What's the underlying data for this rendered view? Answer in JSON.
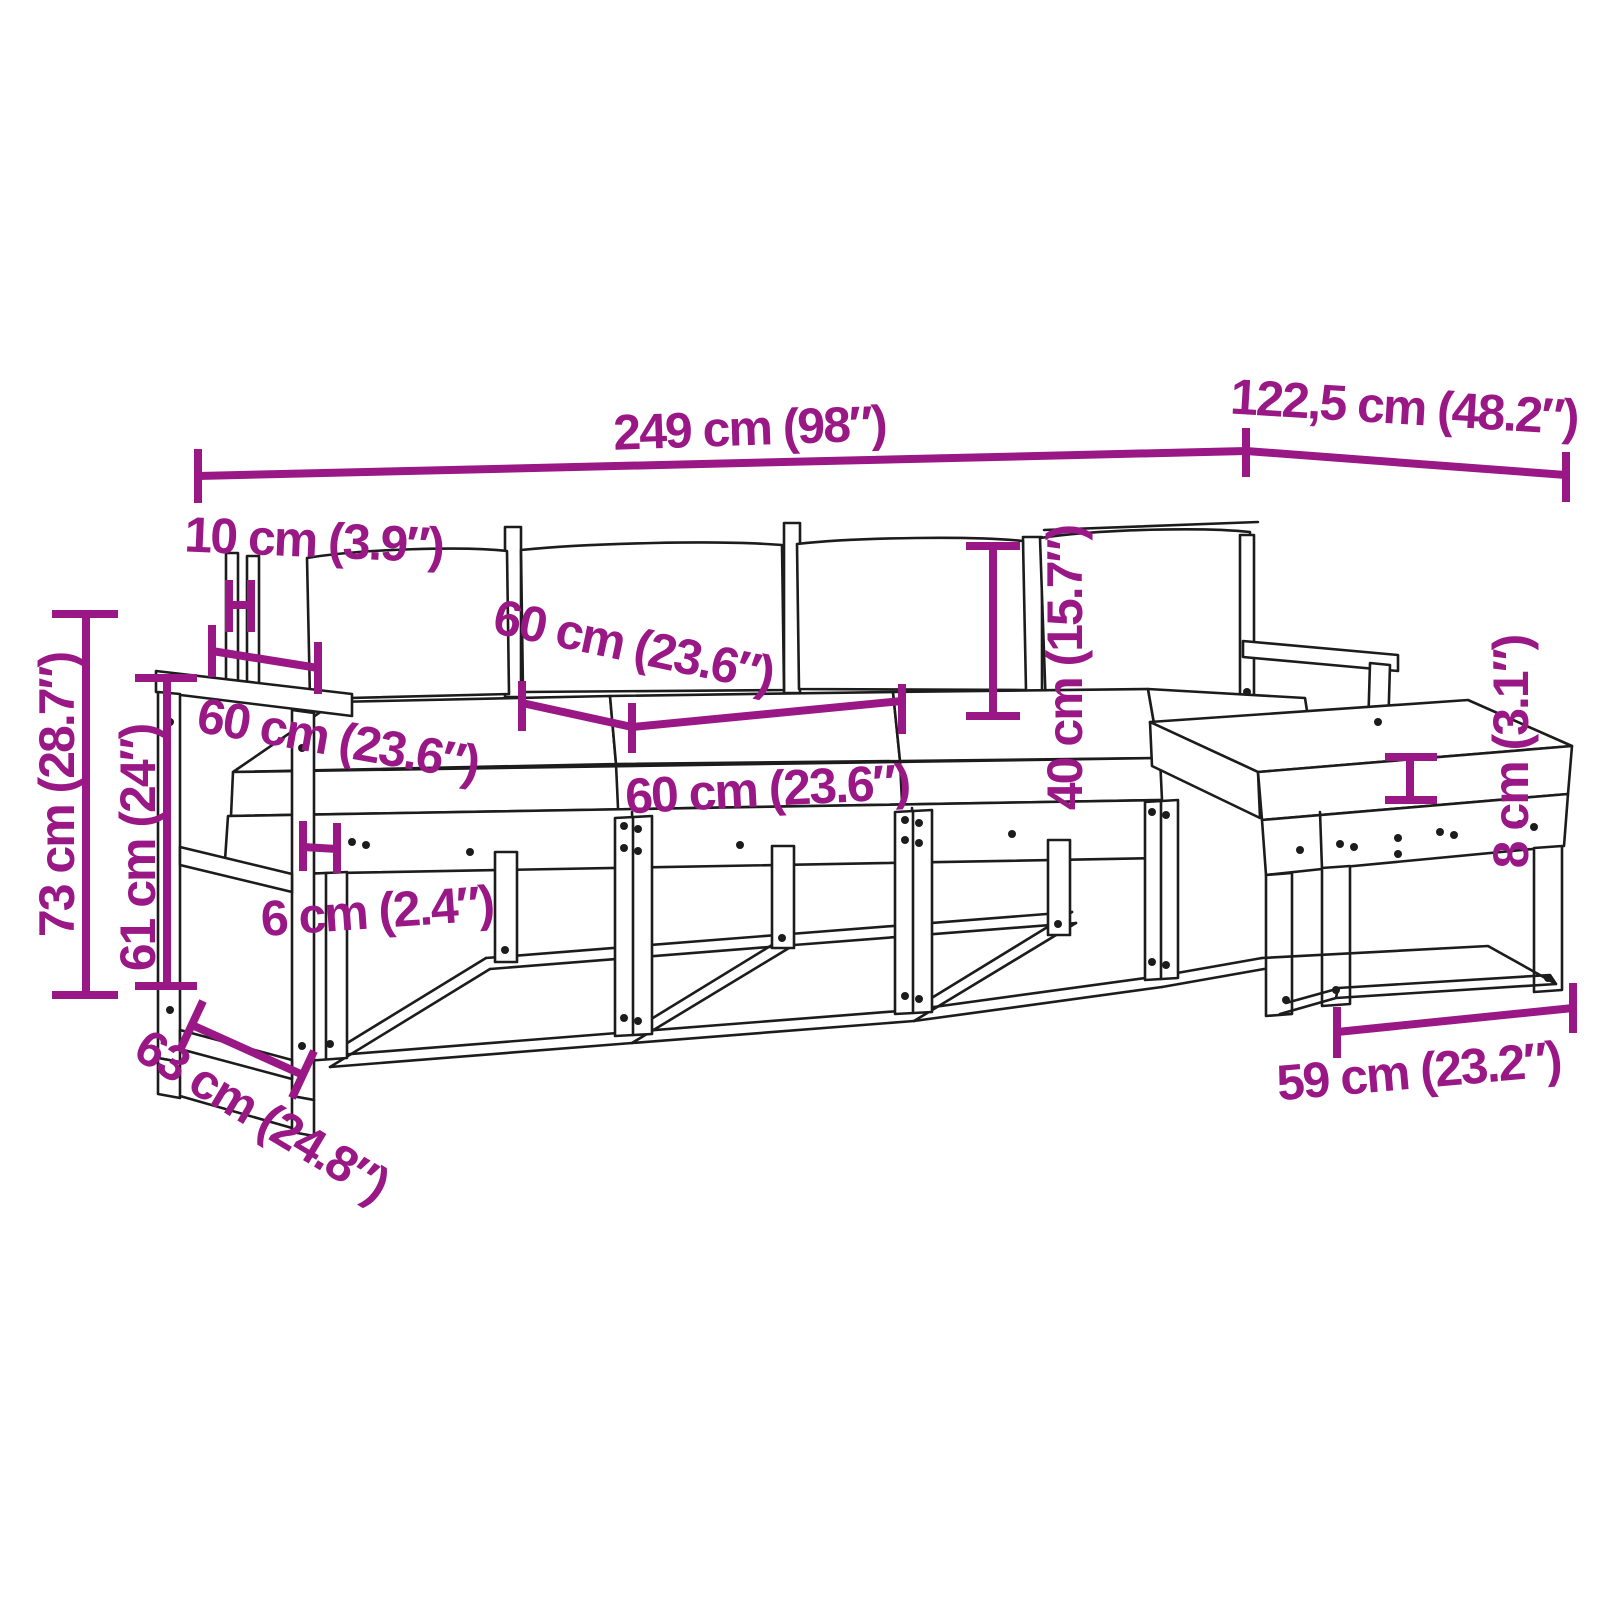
{
  "diagram": {
    "title": "garden-furniture-set-dimension-diagram",
    "pieces": "modular garden sofa set with armrest section, three seats, corner section and footstool",
    "colors": {
      "accent": "#9A1786",
      "line": "#1C1C1C",
      "background": "#FFFFFF"
    },
    "dimensions": {
      "overall_width": {
        "label": "249 cm (98″)"
      },
      "depth_right": {
        "label": "122,5 cm (48.2″)"
      },
      "post_width": {
        "label": "10 cm (3.9″)"
      },
      "armrest_depth": {
        "label": "60 cm (23.6″)"
      },
      "backrest_width": {
        "label": "60 cm (23.6″)"
      },
      "seat_width": {
        "label": "60 cm (23.6″)"
      },
      "backrest_height": {
        "label": "40 cm (15.7″)"
      },
      "overall_height": {
        "label": "73 cm (28.7″)"
      },
      "armrest_height": {
        "label": "61 cm (24″)"
      },
      "clearance": {
        "label": "6 cm (2.4″)"
      },
      "depth_left": {
        "label": "63 cm (24.8″)"
      },
      "stool_width": {
        "label": "59 cm (23.2″)"
      },
      "cushion_thickness": {
        "label": "8 cm (3.1″)"
      }
    }
  }
}
